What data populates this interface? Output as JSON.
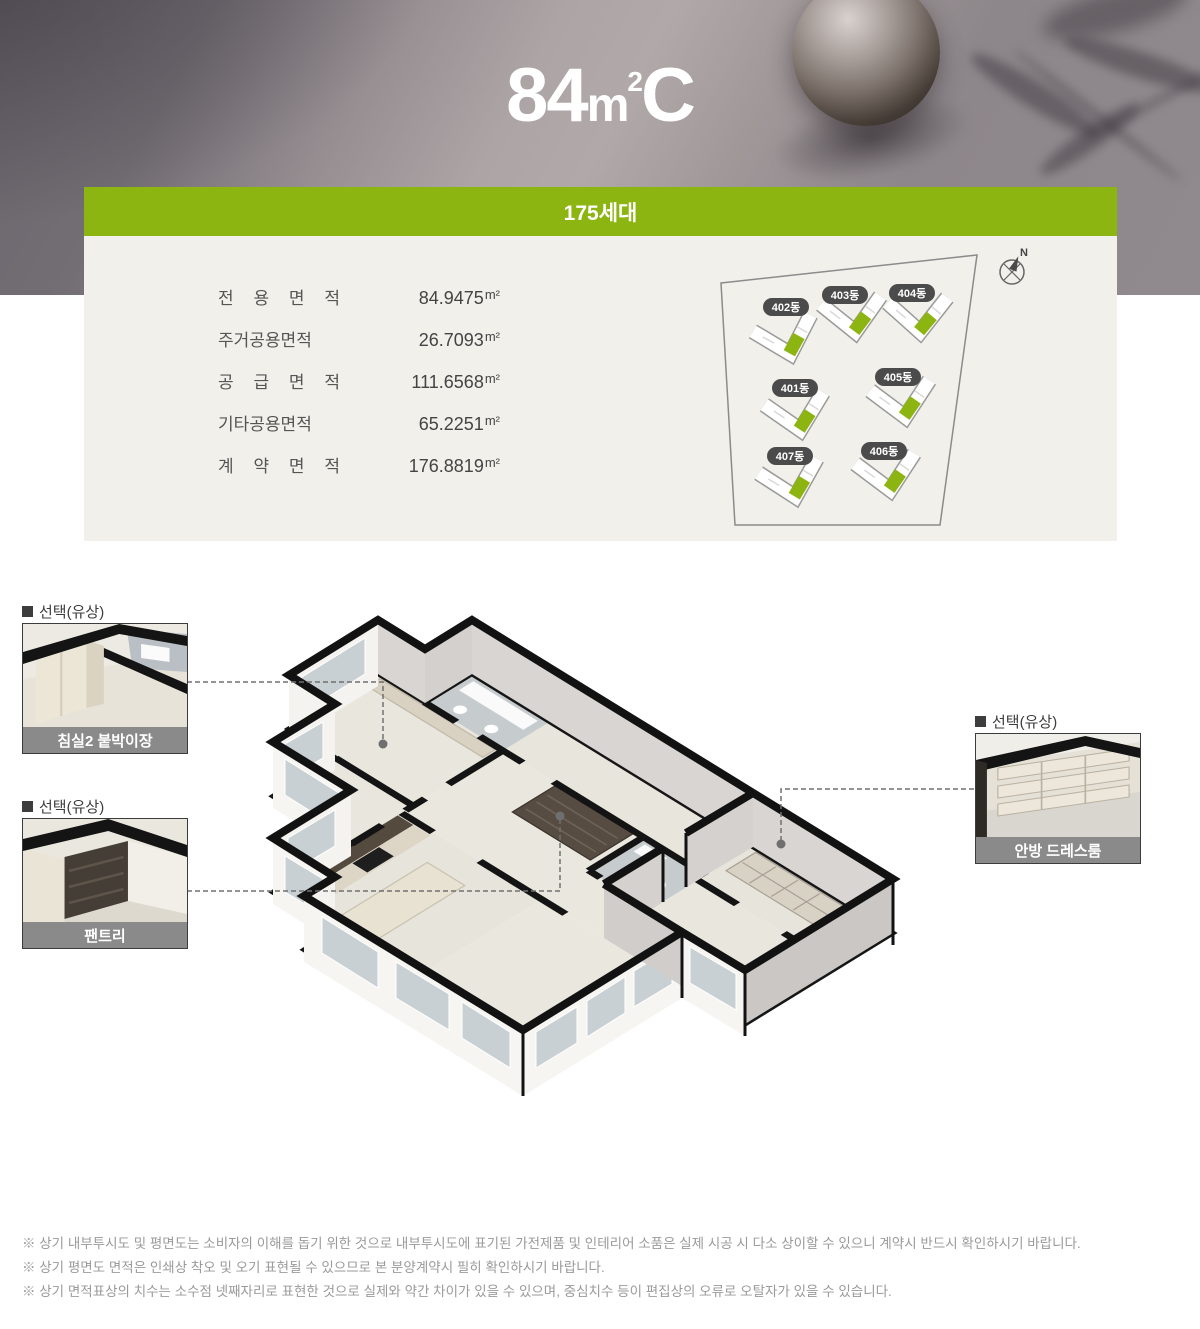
{
  "hero": {
    "title": {
      "full": "84m²C",
      "num": "84",
      "unit": "m",
      "sup": "2",
      "suffix": "C"
    }
  },
  "summary": {
    "badge": "175세대",
    "colors": {
      "green": "#8DB512",
      "panel_bg": "#F1F0EB"
    },
    "area_table": {
      "unit": "m²",
      "rows": [
        {
          "label": "전 용 면 적",
          "value": "84.9475"
        },
        {
          "label": "주거공용면적",
          "value": "26.7093"
        },
        {
          "label": "공 급 면 적",
          "value": "111.6568"
        },
        {
          "label": "기타공용면적",
          "value": "65.2251"
        },
        {
          "label": "계 약 면 적",
          "value": "176.8819"
        }
      ]
    },
    "site_map": {
      "compass": "N",
      "buildings": [
        "402동",
        "403동",
        "404동",
        "401동",
        "405동",
        "407동",
        "406동"
      ]
    }
  },
  "callouts": [
    {
      "tag": "선택(유상)",
      "caption": "침실2 붙박이장"
    },
    {
      "tag": "선택(유상)",
      "caption": "팬트리"
    },
    {
      "tag": "선택(유상)",
      "caption": "안방 드레스룸"
    }
  ],
  "notes": [
    "※ 상기 내부투시도 및 평면도는 소비자의 이해를 돕기 위한 것으로 내부투시도에 표기된 가전제품 및 인테리어 소품은 실제 시공 시 다소 상이할 수 있으니 계약시 반드시 확인하시기 바랍니다.",
    "※ 상기 평면도 면적은 인쇄상 착오 및 오기 표현될 수 있으므로 본 분양계약시 필히 확인하시기 바랍니다.",
    "※ 상기 면적표상의 치수는 소수점 넷째자리로 표현한 것으로 실제와 약간 차이가 있을 수 있으며, 중심치수 등이 편집상의 오류로 오탈자가 있을 수 있습니다."
  ]
}
